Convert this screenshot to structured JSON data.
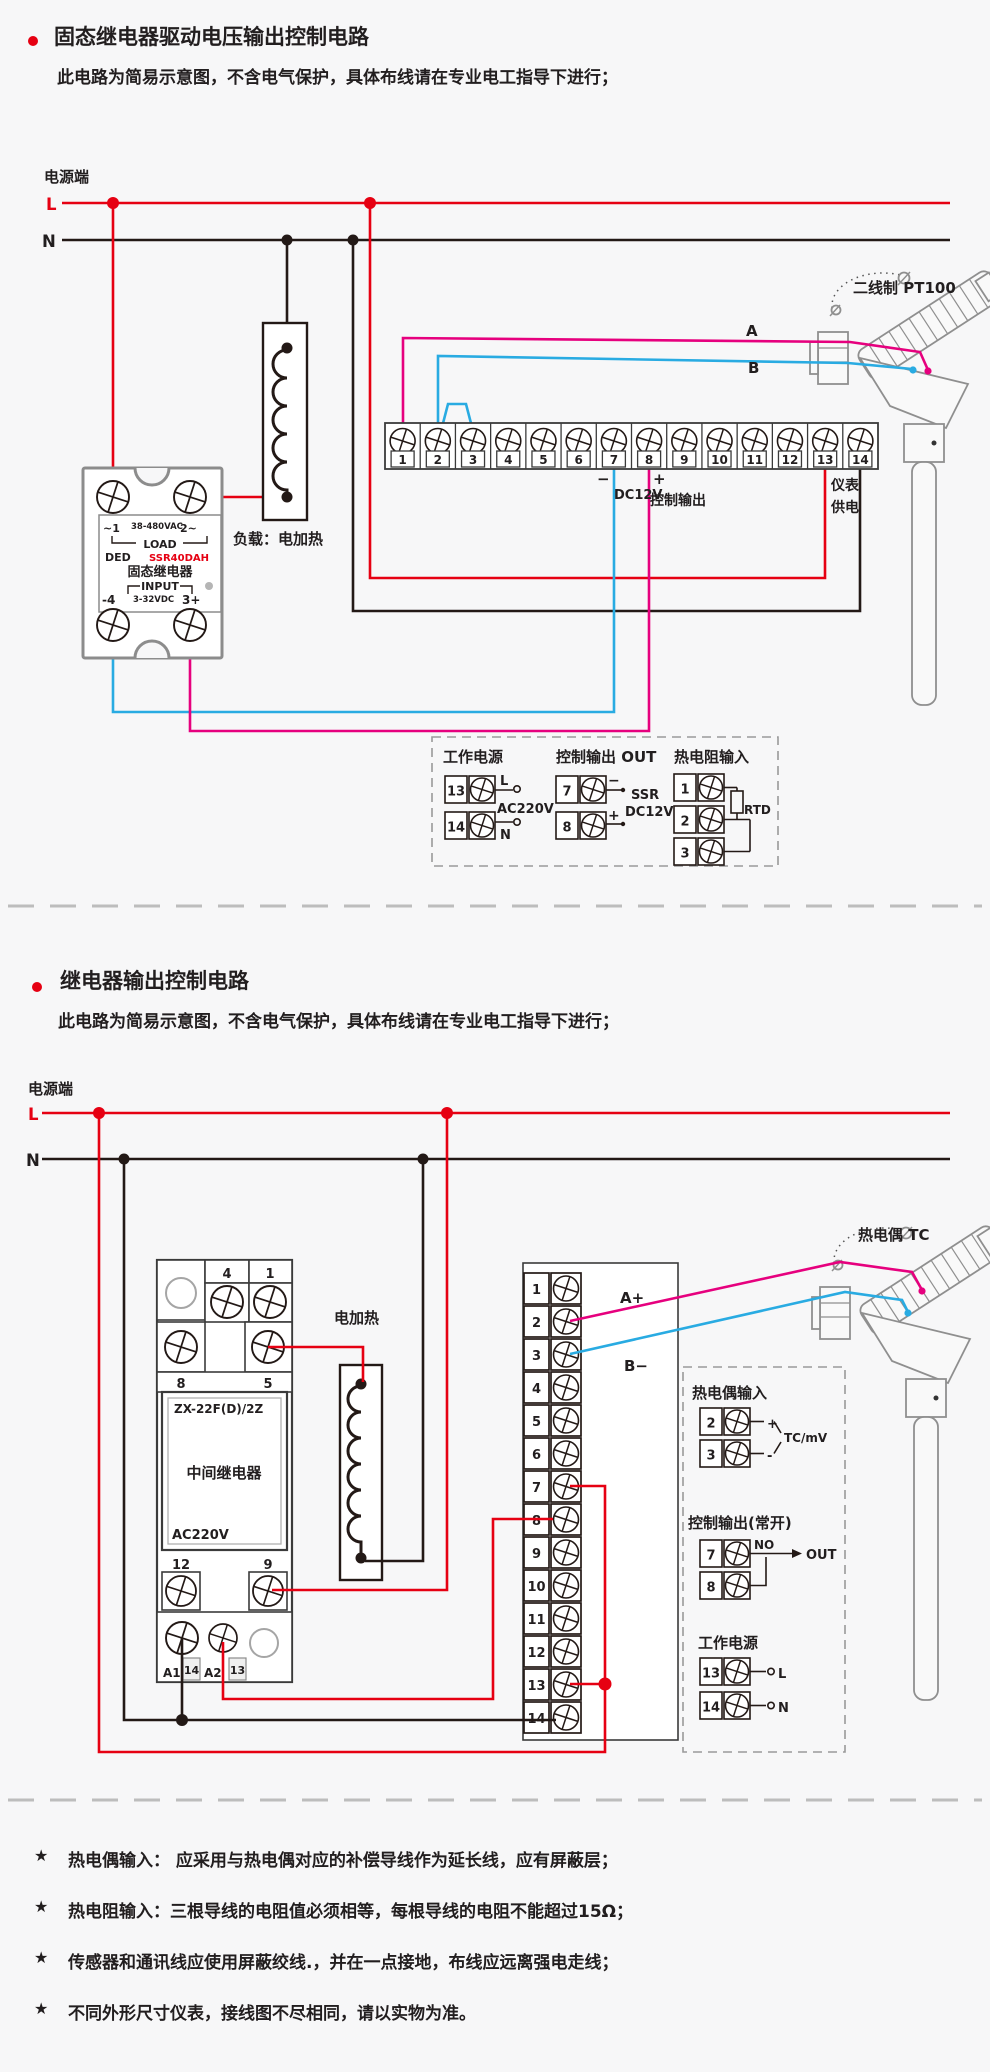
{
  "colors": {
    "wire_red": "#e60012",
    "wire_black": "#231916",
    "wire_blue": "#29abe2",
    "wire_magenta": "#e6007e"
  },
  "section1": {
    "title": "固态继电器驱动电压输出控制电路",
    "subtitle": "此电路为简易示意图，不含电气保护，具体布线请在专业电工指导下进行；",
    "power_label": "电源端",
    "line_l": "L",
    "line_n": "N",
    "sensor_label": "二线制 PT100",
    "wire_a": "A",
    "wire_b": "B",
    "load_label": "负载：电加热",
    "ssr": {
      "ac_left": "~1",
      "ac_range": "38-480VAC",
      "ac_right": "2~",
      "load": "LOAD",
      "brand": "DED",
      "model": "SSR40DAH",
      "name": "固态继电器",
      "input": "INPUT",
      "dc_left": "-4",
      "dc_range": "3-32VDC",
      "dc_right": "3+"
    },
    "terminals": [
      "1",
      "2",
      "3",
      "4",
      "5",
      "6",
      "7",
      "8",
      "9",
      "10",
      "11",
      "12",
      "13",
      "14"
    ],
    "labels": {
      "minus": "−",
      "dc12v": "DC12V",
      "plus": "+",
      "ctrl_out": "控制输出",
      "meter_line1": "仪表",
      "meter_line2": "供电"
    },
    "legend": {
      "power": {
        "title": "工作电源",
        "t_top": "13",
        "t_bottom": "14",
        "l": "L",
        "mid": "AC220V",
        "n": "N"
      },
      "output": {
        "title": "控制输出 OUT",
        "t_top": "7",
        "t_bottom": "8",
        "minus": "−",
        "plus": "+",
        "line1": "SSR",
        "line2": "DC12V"
      },
      "rtd": {
        "title": "热电阻输入",
        "t1": "1",
        "t2": "2",
        "t3": "3",
        "label": "RTD"
      }
    }
  },
  "section2": {
    "title": "继电器输出控制电路",
    "subtitle": "此电路为简易示意图，不含电气保护，具体布线请在专业电工指导下进行；",
    "power_label": "电源端",
    "line_l": "L",
    "line_n": "N",
    "sensor_label": "热电偶 TC",
    "heater_label": "电加热",
    "wire_a": "A+",
    "wire_b": "B−",
    "relay": {
      "model": "ZX-22F(D)/2Z",
      "name": "中间继电器",
      "volt": "AC220V",
      "t4": "4",
      "t1": "1",
      "t8": "8",
      "t5": "5",
      "t12": "12",
      "t9": "9",
      "a1": "A1",
      "n14": "14",
      "a2": "A2",
      "n13": "13"
    },
    "terminals": [
      "1",
      "2",
      "3",
      "4",
      "5",
      "6",
      "7",
      "8",
      "9",
      "10",
      "11",
      "12",
      "13",
      "14"
    ],
    "legend": {
      "tc": {
        "title": "热电偶输入",
        "t_top": "2",
        "t_bottom": "3",
        "plus": "+",
        "minus": "-",
        "label": "TC/mV"
      },
      "output": {
        "title": "控制输出(常开)",
        "t_top": "7",
        "t_bottom": "8",
        "no": "NO",
        "out": "OUT"
      },
      "power": {
        "title": "工作电源",
        "t_top": "13",
        "t_bottom": "14",
        "l": "L",
        "n": "N"
      }
    }
  },
  "footnotes": [
    {
      "bullet": "★",
      "text": "热电偶输入： 应采用与热电偶对应的补偿导线作为延长线，应有屏蔽层；"
    },
    {
      "bullet": "★",
      "text": "热电阻输入：三根导线的电阻值必须相等，每根导线的电阻不能超过15Ω；"
    },
    {
      "bullet": "★",
      "text": "传感器和通讯线应使用屏蔽绞线.，并在一点接地，布线应远离强电走线；"
    },
    {
      "bullet": "★",
      "text": "不同外形尺寸仪表，接线图不尽相同，请以实物为准。"
    }
  ]
}
